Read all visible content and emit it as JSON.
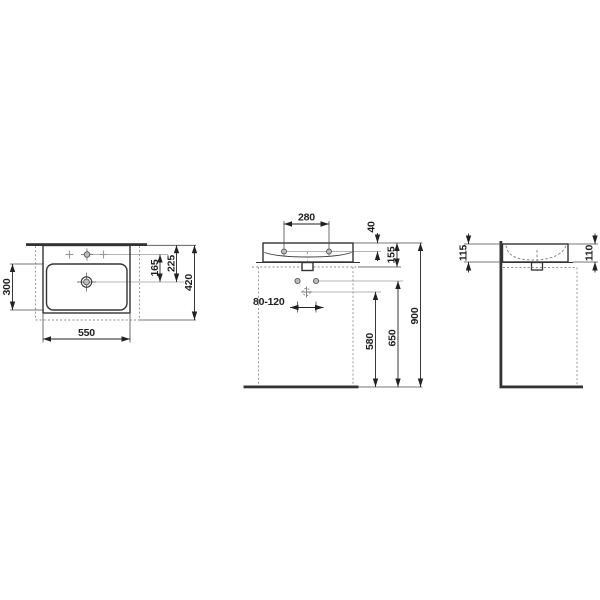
{
  "drawing_title": "washbasin-technical-dimension-drawing",
  "colors": {
    "background": "#ffffff",
    "main_line": "#333333",
    "dimension_line": "#222222",
    "leader_line": "#b5b5b5",
    "dashed_line": "#8f8f8f",
    "hole_fill": "#bdbdbd"
  },
  "plan_view": {
    "dims": {
      "width": "550",
      "bowl_depth": "300",
      "taphole_to_drain": "165",
      "rear_to_drain": "225",
      "total_depth": "420"
    }
  },
  "front_view": {
    "dims": {
      "taphole_spacing": "280",
      "rim_to_taphole": "40",
      "rim_to_underside": "155",
      "outlet_offset_range": "80-120",
      "floor_to_drain": "580",
      "floor_to_valves": "650",
      "floor_to_rim": "900"
    }
  },
  "side_view": {
    "dims": {
      "rear_height": "115",
      "front_height": "110"
    }
  }
}
